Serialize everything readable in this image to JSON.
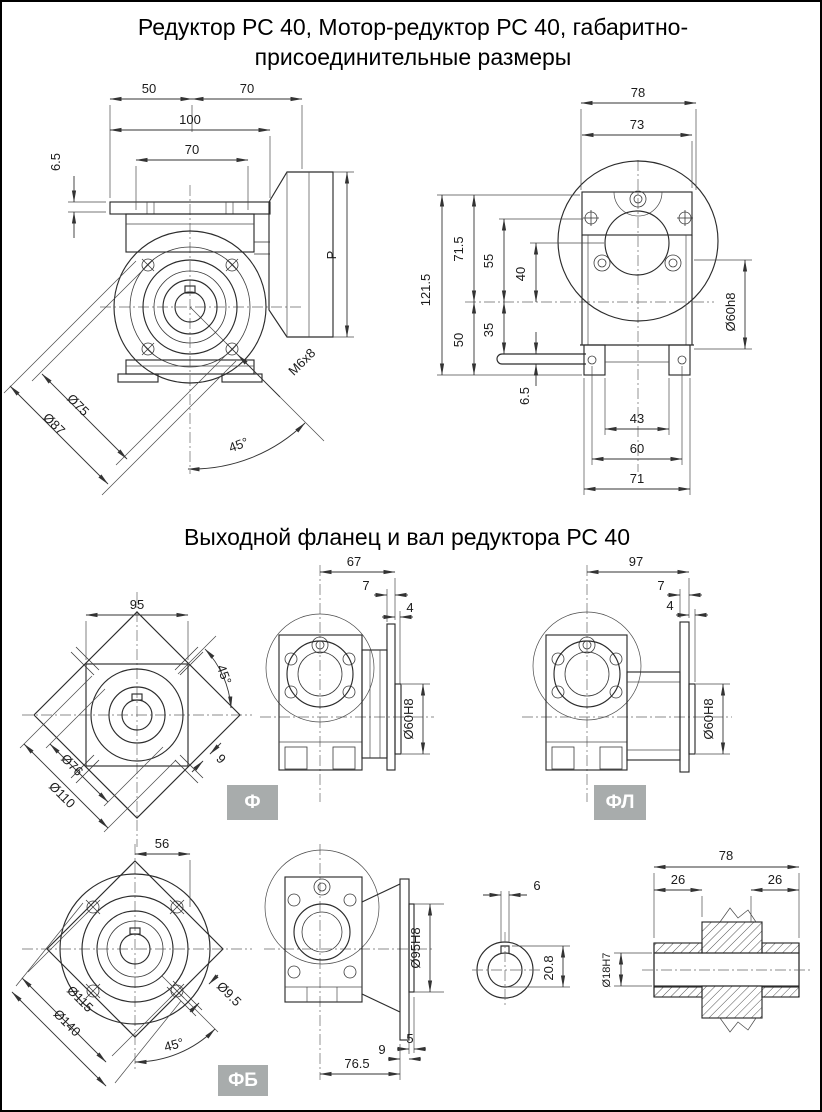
{
  "t": {
    "title1": "Редуктор РС 40, Мотор-редуктор РС 40, габаритно-",
    "title2": "присоединительные размеры",
    "sec2": "Выходной фланец и вал редуктора РС 40",
    "lblF": "Ф",
    "lblFL": "ФЛ",
    "lblFB": "ФБ"
  },
  "colors": {
    "line": "#2c2c2c",
    "label_bg": "#a8acac",
    "label_text": "#ffffff"
  },
  "a": {
    "d50": "50",
    "d70a": "70",
    "d100": "100",
    "d70b": "70",
    "d65": "6.5",
    "P": "P",
    "d75": "Ø75",
    "d87": "Ø87",
    "m68": "M6x8",
    "a45": "45°"
  },
  "b": {
    "d78": "78",
    "d73": "73",
    "d1215": "121.5",
    "d715": "71.5",
    "d55": "55",
    "d40": "40",
    "d50": "50",
    "d35": "35",
    "d65": "6.5",
    "d60h8": "Ø60h8",
    "d43": "43",
    "d60": "60",
    "d71": "71"
  },
  "c": {
    "d95": "95",
    "a45": "45°",
    "d76": "Ø76",
    "d110": "Ø110",
    "d9": "9"
  },
  "d": {
    "d67": "67",
    "d7": "7",
    "d4": "4",
    "d60H8": "Ø60H8"
  },
  "e": {
    "d97": "97",
    "d7": "7",
    "d4": "4",
    "d60H8": "Ø60H8"
  },
  "f": {
    "d56": "56",
    "d115": "Ø115",
    "d140": "Ø140",
    "d95q": "Ø9.5",
    "a45": "45°"
  },
  "g": {
    "d95H8": "Ø95H8",
    "d5": "5",
    "d9": "9",
    "d765": "76.5"
  },
  "h": {
    "d6": "6",
    "d208": "20.8",
    "d78": "78",
    "d26a": "26",
    "d26b": "26",
    "d18": "Ø18H7"
  }
}
